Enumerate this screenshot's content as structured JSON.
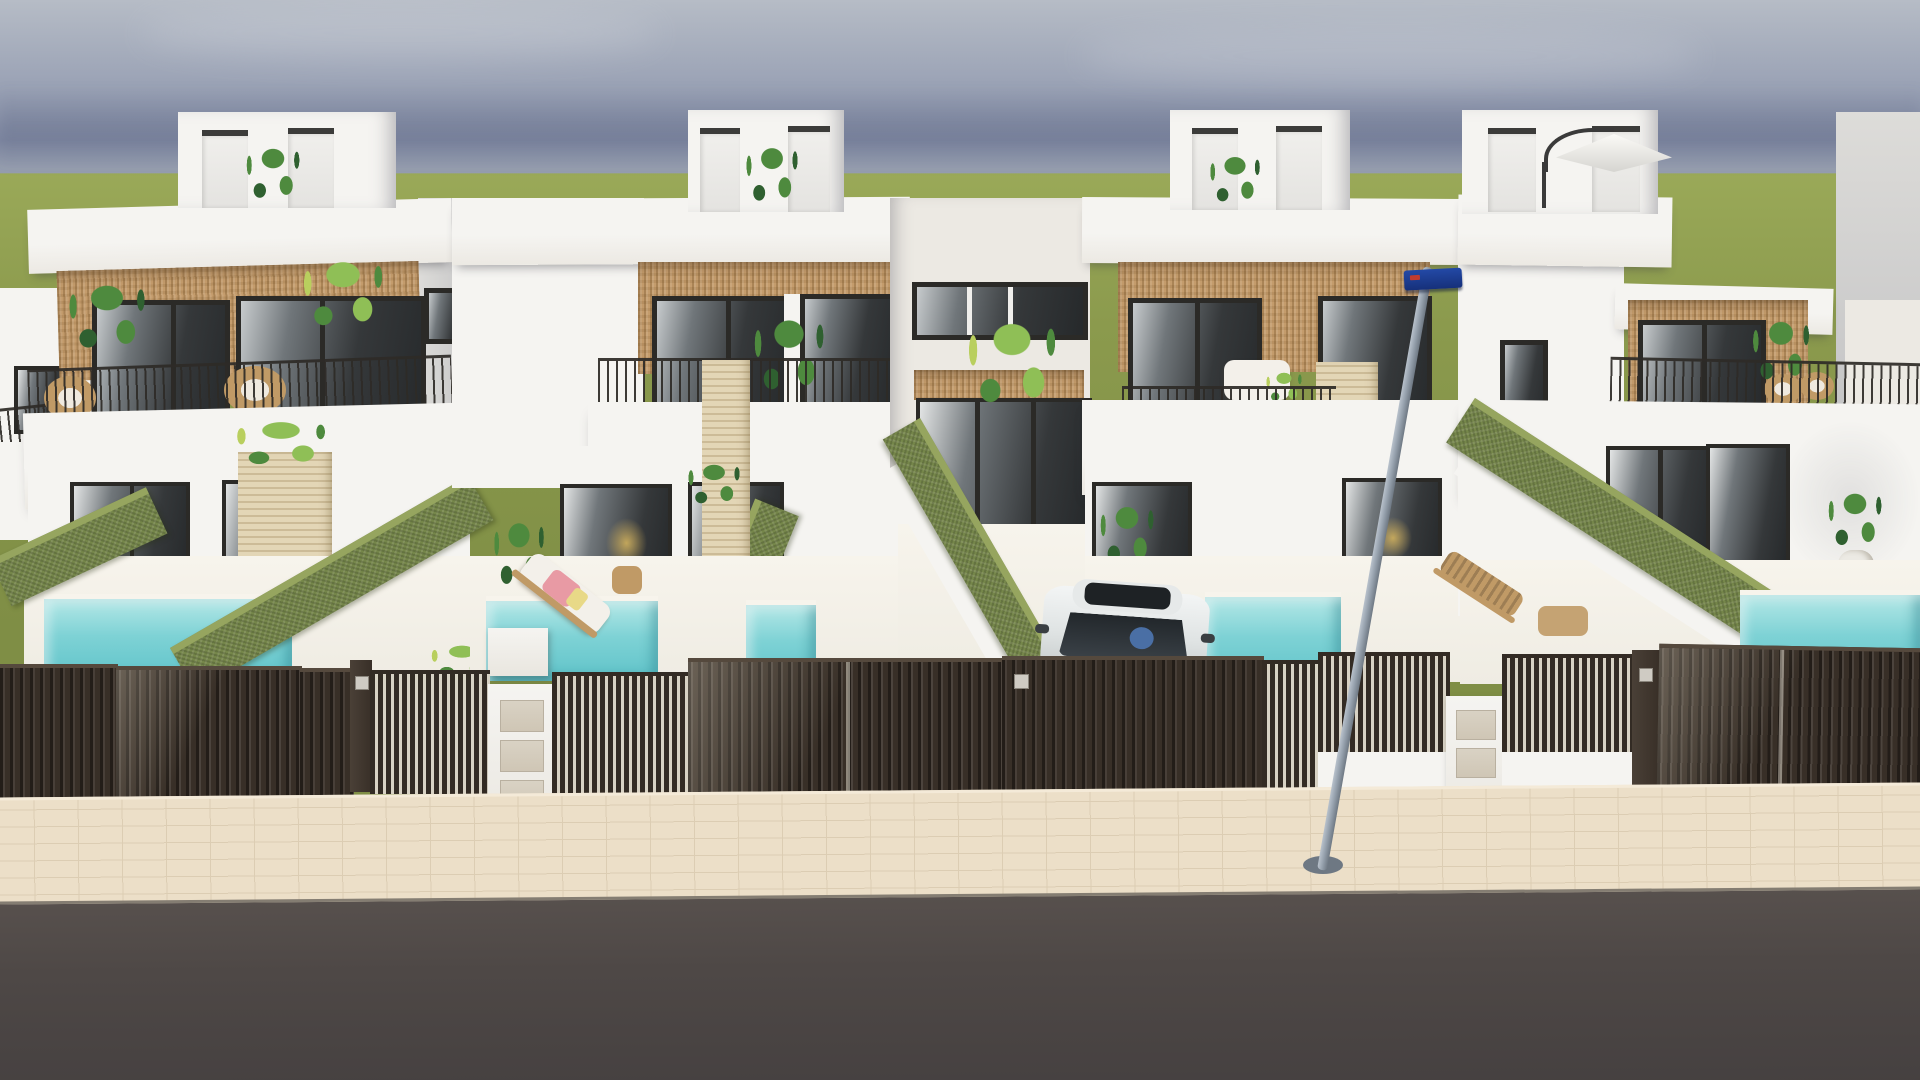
{
  "meta": {
    "kind": "architectural-exterior-render",
    "description": "Photorealistic 3D render of a row of four modern two-storey white townhouses viewed from the street. Each house has a rooftop terrace box with plants (one with a white cantilever umbrella), a rattan-clad upper floor with dark-framed sliding windows, a balcony with thin black railings and wicker or white lounge furniture, travertine divider pillars, a ground floor with dark glazed doors, and a small private front yard with a turquoise plunge pool, olive-green artificial hedge walls, sun loungers and potted plants. Dark slatted gates and fences with white mailbox pillars line the street. A white car is parked behind the central gate, a grey lamp post with a blue street sign stands on the cream paved sidewalk, and a dark asphalt road runs across the foreground. Green fields and a hazy blue-grey sky fill the horizon.",
    "width_px": 1920,
    "height_px": 1080
  },
  "colors": {
    "sky_top": "#b6bcc6",
    "sky_mid": "#9aa2b5",
    "sky_deep": "#7f88a2",
    "sky_horizon": "#959dae",
    "grass_light": "#9aa958",
    "grass": "#8b9a4d",
    "grass_dark": "#7f8e45",
    "wall": "#f5f4f1",
    "wall_warm": "#ece9e3",
    "wall_shade": "#dddcd9",
    "wall_dark": "#c5c5c6",
    "rattan": "#c49c6c",
    "rattan_dark": "#a8824f",
    "frame": "#2b2a27",
    "glass_dark": "#35383a",
    "glass_mid": "#70767a",
    "glass_light": "#c7cbcd",
    "railing": "#2e2b27",
    "hedge": "#75864a",
    "hedge_light": "#96a55f",
    "hedge_dark": "#5f7039",
    "pool": "#7ed2d5",
    "pool_light": "#b5e8e7",
    "pool_deep": "#5fc3c9",
    "patio": "#efece3",
    "coping": "#f7f4ec",
    "fence": "#382f27",
    "fence_light": "#55493d",
    "gate_gap": "#d8d2c4",
    "travertine": "#e3d6b6",
    "sidewalk": "#ecdfc8",
    "sidewalk_line": "#dccdb3",
    "road": "#57504d",
    "road_dark": "#454040",
    "car_body": "#eef0f0",
    "car_glass": "#2f3337",
    "driver_blue": "#4a6fa5",
    "pole": "#97a2ae",
    "pole_dark": "#6e7883",
    "sign_blue": "#2349a6",
    "sign_dark": "#16307a",
    "sign_red": "#c03b30",
    "plant_green": "#4e8a3e",
    "plant_dark": "#2f6030",
    "plant_light": "#8fbf56",
    "plant_yellow": "#b9cf5e",
    "wood": "#c09a66",
    "cushion": "#f3f0ea",
    "towel_pink": "#e89aa4",
    "towel_yellow": "#e8d987",
    "interior_warm": "#d8b65e"
  },
  "objects": {
    "houses": [
      {
        "position": "far-left",
        "features": [
          "rooftop box with two access doors and plant",
          "rattan upper facade",
          "two dark sliding windows",
          "balcony with black railing and wicker chairs",
          "travertine pillar with plant",
          "two glazed ground doors",
          "turquoise pool",
          "hedge walls",
          "slatted dark gates"
        ]
      },
      {
        "position": "center-left",
        "features": [
          "rooftop box with plant",
          "rattan facade",
          "balcony railing",
          "sun lounger with pink and yellow towels",
          "wooden side table",
          "two pools",
          "travertine pillar",
          "white planters",
          "mailbox pillar"
        ]
      },
      {
        "position": "center-right",
        "features": [
          "rooftop box with plant",
          "rattan facade",
          "white balcony sofa set",
          "travertine pillar",
          "driveway with parked white car",
          "pool right of car",
          "dark entrance gates"
        ]
      },
      {
        "position": "far-right",
        "features": [
          "rooftop box with white cantilever umbrella",
          "rear wing with rattan facade",
          "balcony with wicker chairs and large plant",
          "potted plant by glazed doors",
          "tree shadow on wall",
          "wooden lounger",
          "corner pool",
          "slatted gates"
        ]
      }
    ],
    "shared_elements": [
      "central recessed entry corridor with wood-slat canopy and full-height dark glazing",
      "long olive hedge wall along the driveway",
      "green field horizon",
      "hazy blue-grey sky with thin clouds"
    ],
    "street": {
      "lamp_post": "grey tilted pole with round base",
      "street_sign": "dark blue rectangular sign with small red marking",
      "car": "white compact car with dark windshield, sunroof and visible driver",
      "sidewalk": "cream herringbone pavers",
      "road": "dark grey asphalt"
    },
    "counts": {
      "houses": 4,
      "rooftop_boxes": 4,
      "visible_pools": 5,
      "hedge_walls": 5,
      "sun_loungers": 3,
      "mailbox_pillars": 2,
      "gates_and_fence_panels": 12
    }
  }
}
